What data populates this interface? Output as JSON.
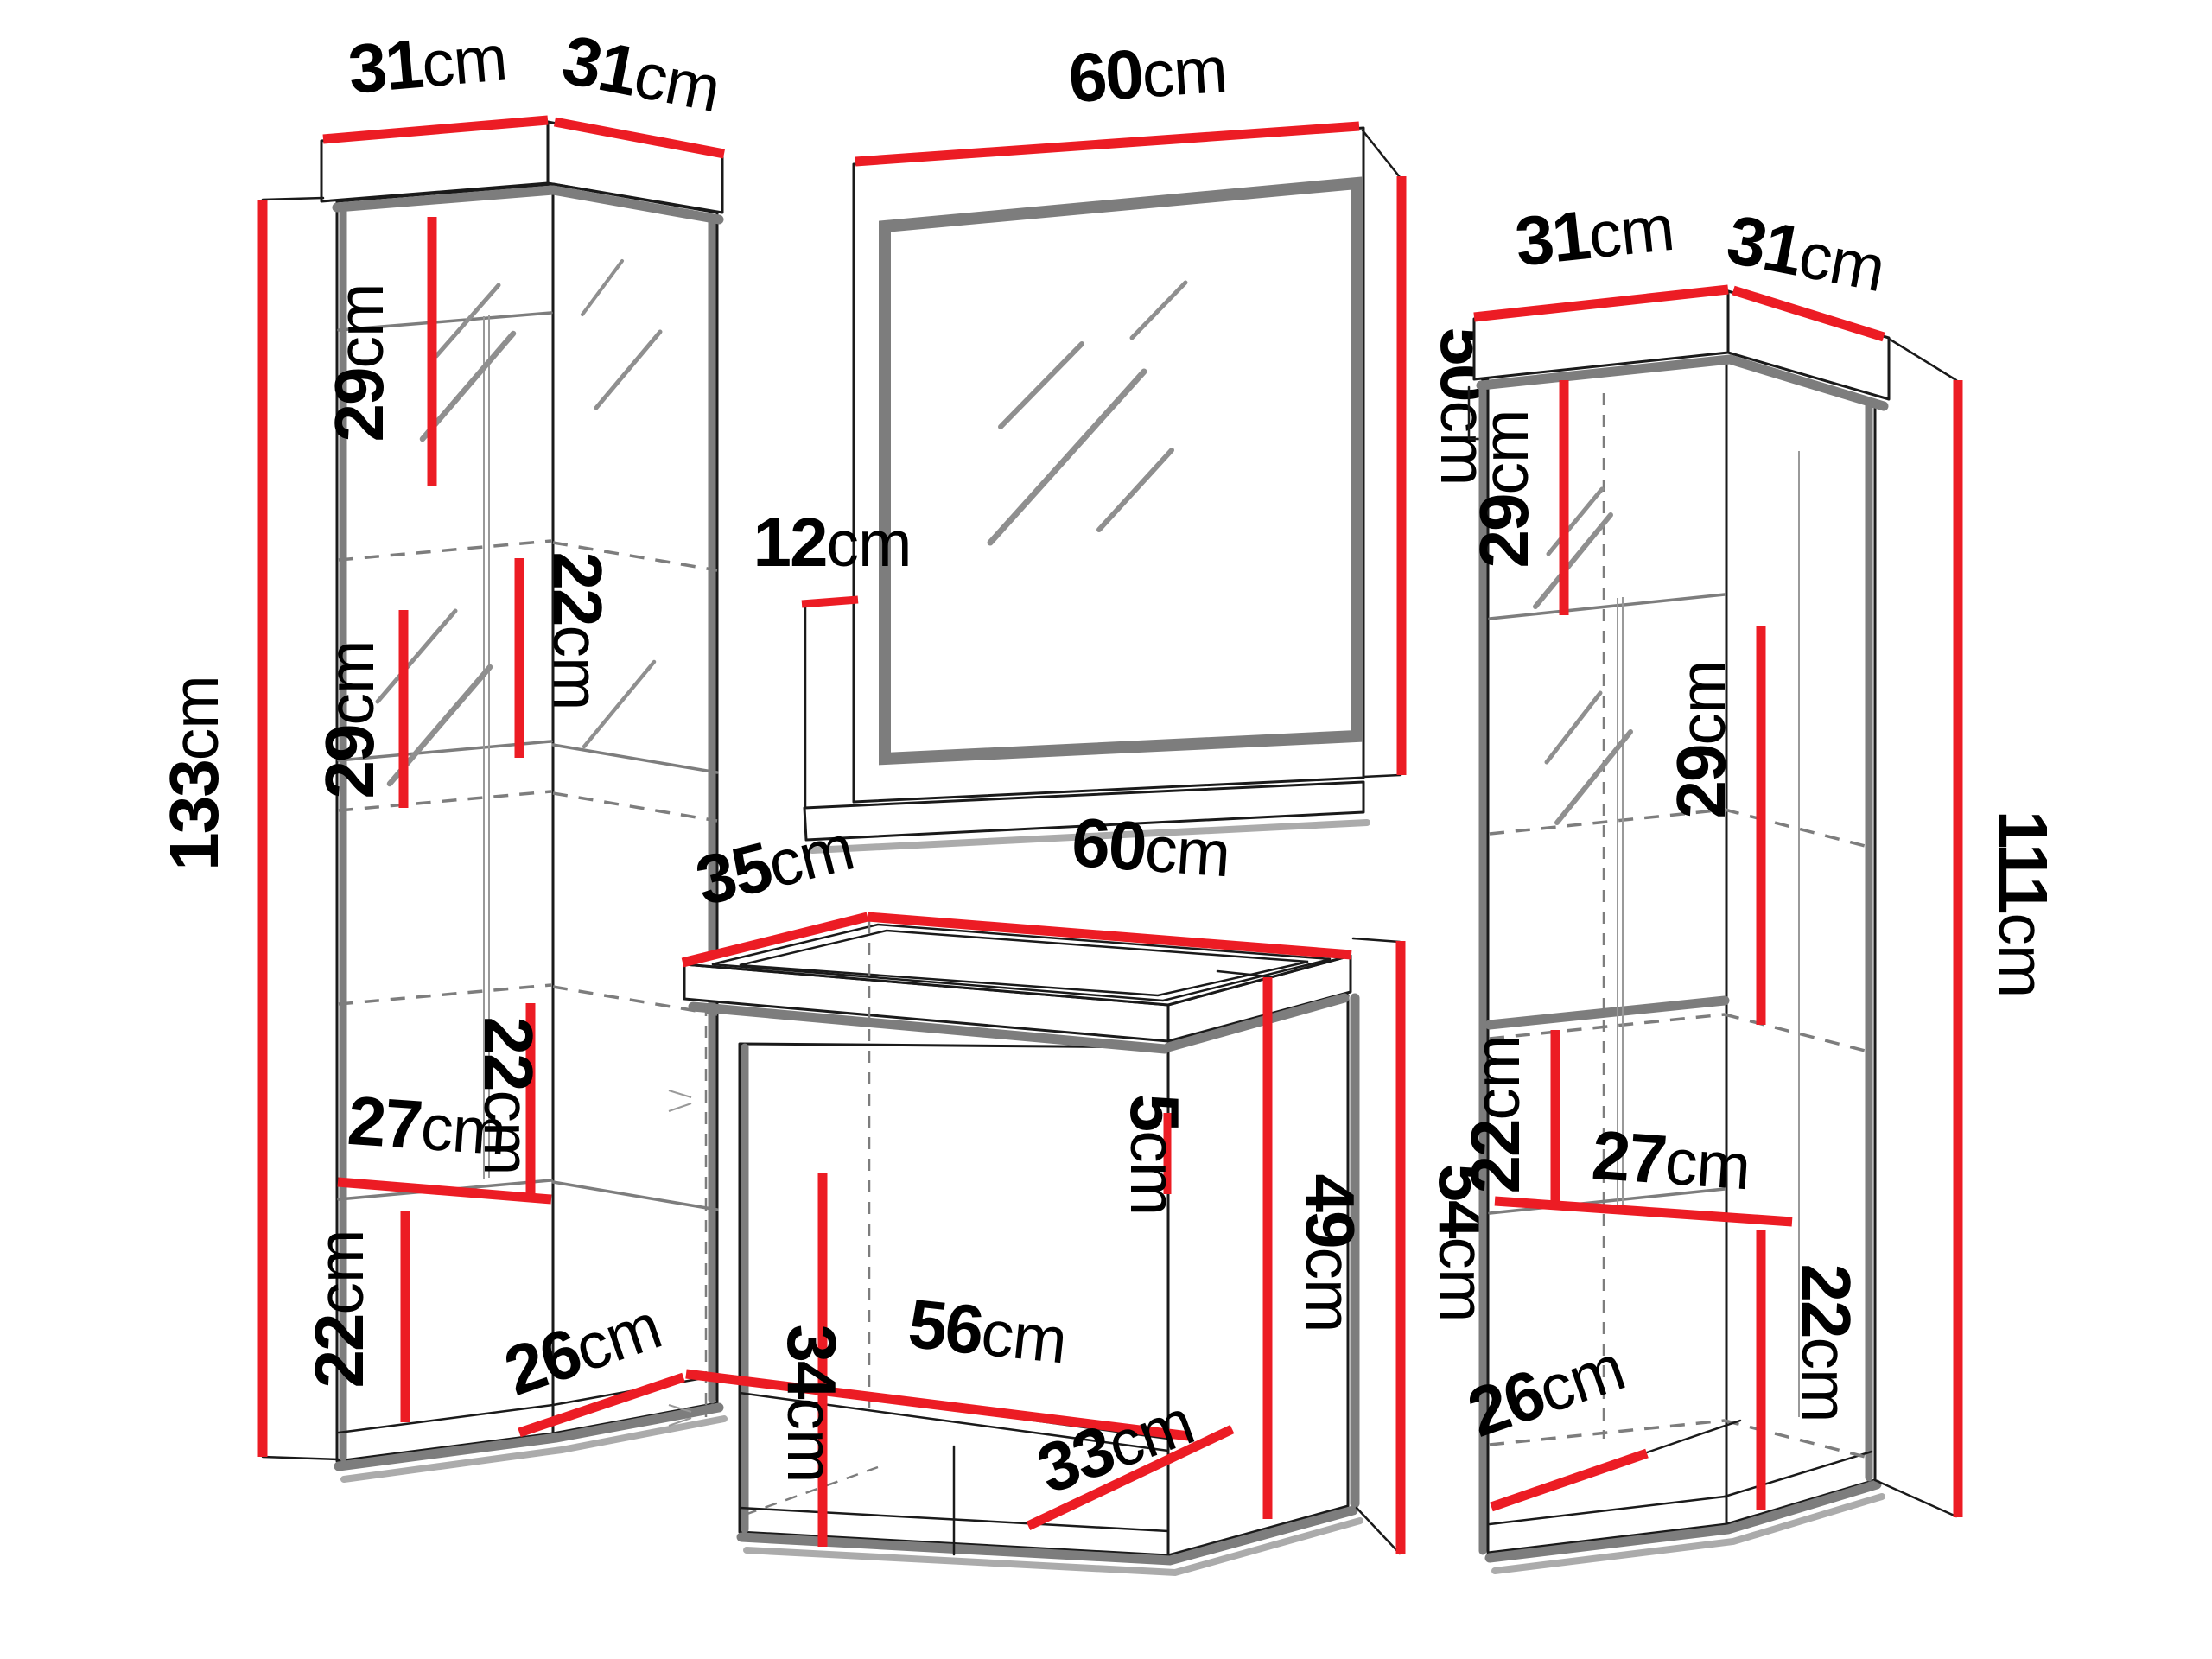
{
  "diagram_title": "bathroom-furniture-set-dimensions",
  "colors": {
    "dimension_line": "#ec1c24",
    "outline": "#1a1a1a",
    "structure_gray": "#7d7d7d",
    "shadow_gray": "#ababab",
    "background": "#ffffff"
  },
  "dimensions": {
    "left_cabinet": {
      "top_width": {
        "v": "31",
        "u": "cm"
      },
      "top_depth": {
        "v": "31",
        "u": "cm"
      },
      "height": {
        "v": "133",
        "u": "cm"
      },
      "shelf_top": {
        "v": "29",
        "u": "cm"
      },
      "shelf_upper_mid": {
        "v": "22",
        "u": "cm"
      },
      "shelf_mid": {
        "v": "29",
        "u": "cm"
      },
      "shelf_lower_mid": {
        "v": "22",
        "u": "cm"
      },
      "inner_width": {
        "v": "27",
        "u": "cm"
      },
      "shelf_bottom": {
        "v": "22",
        "u": "cm"
      },
      "inner_depth": {
        "v": "26",
        "u": "cm"
      }
    },
    "mirror": {
      "width": {
        "v": "60",
        "u": "cm"
      },
      "height": {
        "v": "50",
        "u": "cm"
      },
      "shelf_depth": {
        "v": "12",
        "u": "cm"
      }
    },
    "sink_cabinet": {
      "top_depth": {
        "v": "35",
        "u": "cm"
      },
      "top_width": {
        "v": "60",
        "u": "cm"
      },
      "basin_height": {
        "v": "5",
        "u": "cm"
      },
      "inner_width": {
        "v": "56",
        "u": "cm"
      },
      "inner_height": {
        "v": "34",
        "u": "cm"
      },
      "inner_depth": {
        "v": "33",
        "u": "cm"
      },
      "door_height": {
        "v": "49",
        "u": "cm"
      },
      "total_height": {
        "v": "54",
        "u": "cm"
      }
    },
    "right_cabinet": {
      "top_width": {
        "v": "31",
        "u": "cm"
      },
      "top_depth": {
        "v": "31",
        "u": "cm"
      },
      "height": {
        "v": "111",
        "u": "cm"
      },
      "shelf_top": {
        "v": "29",
        "u": "cm"
      },
      "shelf_mid": {
        "v": "29",
        "u": "cm"
      },
      "shelf_lower": {
        "v": "22",
        "u": "cm"
      },
      "inner_width": {
        "v": "27",
        "u": "cm"
      },
      "shelf_bottom": {
        "v": "22",
        "u": "cm"
      },
      "inner_depth": {
        "v": "26",
        "u": "cm"
      }
    }
  }
}
